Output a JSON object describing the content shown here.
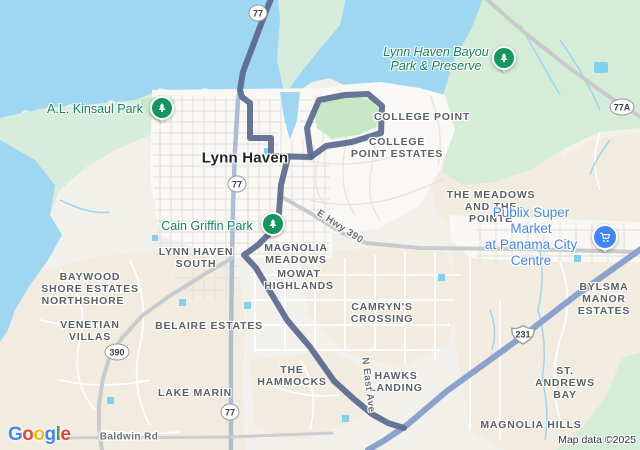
{
  "map": {
    "city": {
      "text": "Lynn Haven"
    },
    "neighborhoods": [
      {
        "text": "COLLEGE POINT"
      },
      {
        "text": "COLLEGE\nPOINT ESTATES"
      },
      {
        "text": "THE MEADOWS\nAND THE\nPOINTE"
      },
      {
        "text": "LYNN HAVEN\nSOUTH"
      },
      {
        "text": "MAGNOLIA\nMEADOWS"
      },
      {
        "text": "MOWAT\nHIGHLANDS"
      },
      {
        "text": "BAYWOOD\nSHORE ESTATES"
      },
      {
        "text": "NORTHSHORE"
      },
      {
        "text": "VENETIAN\nVILLAS"
      },
      {
        "text": "BELAIRE ESTATES"
      },
      {
        "text": "CAMRYN'S\nCROSSING"
      },
      {
        "text": "THE\nHAMMOCKS"
      },
      {
        "text": "HAWKS\nLANDING"
      },
      {
        "text": "LAKE MARIN"
      },
      {
        "text": "BYLSMA\nMANOR ESTATES"
      },
      {
        "text": "ST. ANDREWS\nBAY"
      },
      {
        "text": "MAGNOLIA HILLS"
      }
    ],
    "parks": [
      {
        "text": "A.L. Kinsaul Park"
      },
      {
        "text": "Lynn Haven Bayou\nPark & Preserve"
      },
      {
        "text": "Cain Griffin Park"
      }
    ],
    "poi": {
      "text": "Publix Super Market\nat Panama City Centre"
    },
    "road_labels": [
      {
        "text": "E Hwy 390"
      },
      {
        "text": "N East Ave"
      },
      {
        "text": "Baldwin Rd"
      }
    ],
    "shields": [
      {
        "label": "77"
      },
      {
        "label": "77A"
      },
      {
        "label": "77"
      },
      {
        "label": "390"
      },
      {
        "label": "77"
      },
      {
        "label": "231"
      }
    ],
    "colors": {
      "water": "#9fd6f2",
      "route": "#5a6a90",
      "highway_231": "#8ba2cc",
      "highway_77": "#aebdd4",
      "park_green": "#c7e8c5",
      "preserve_green": "#d5ecd7",
      "residential_beige": "#f1ecdf",
      "park_label_green": "#12855b",
      "poi_blue": "#4285f4",
      "marker_green": "#12975c"
    }
  },
  "footer": {
    "logo": [
      {
        "ch": "G",
        "color": "#4285F4"
      },
      {
        "ch": "o",
        "color": "#EA4335"
      },
      {
        "ch": "o",
        "color": "#FBBC05"
      },
      {
        "ch": "g",
        "color": "#4285F4"
      },
      {
        "ch": "l",
        "color": "#34A853"
      },
      {
        "ch": "e",
        "color": "#EA4335"
      }
    ],
    "attribution": "Map data ©2025"
  }
}
